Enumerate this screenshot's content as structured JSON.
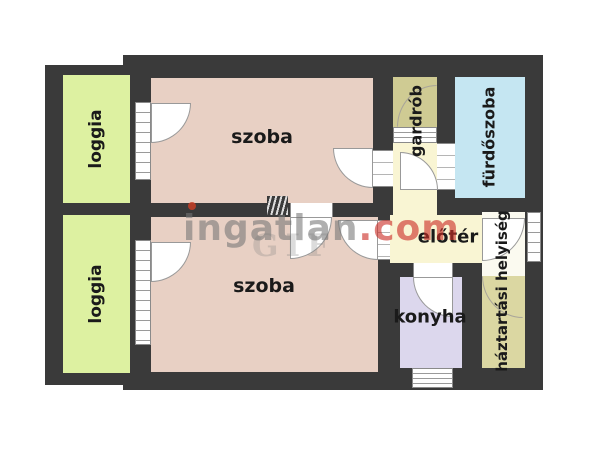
{
  "plan_title": "apartment floor plan",
  "rooms": {
    "loggia_top": {
      "label": "loggia"
    },
    "loggia_bottom": {
      "label": "loggia"
    },
    "szoba_top": {
      "label": "szoba"
    },
    "szoba_bottom": {
      "label": "szoba"
    },
    "gardrob": {
      "label": "gardrób"
    },
    "furdoszoba": {
      "label": "fürdőszoba"
    },
    "eloter": {
      "label": "előtér"
    },
    "haztartasi": {
      "label": "háztartási helyiség"
    },
    "konyha": {
      "label": "konyha"
    }
  },
  "watermark": {
    "brand": "ingatlan",
    "tld": ".com",
    "ghost_letters": "GIF"
  },
  "colors": {
    "wall": "#3a3a3a",
    "loggia": "#ddf1a1",
    "szoba": "#e8d0c4",
    "gardrob": "#cfcb93",
    "furdoszoba": "#c5e6f2",
    "eloter": "#f9f5d3",
    "haztartasi": "#dbd7a2",
    "konyha": "#dcd7ed",
    "watermark_gray": "#767676",
    "watermark_red": "#cb2f28"
  }
}
